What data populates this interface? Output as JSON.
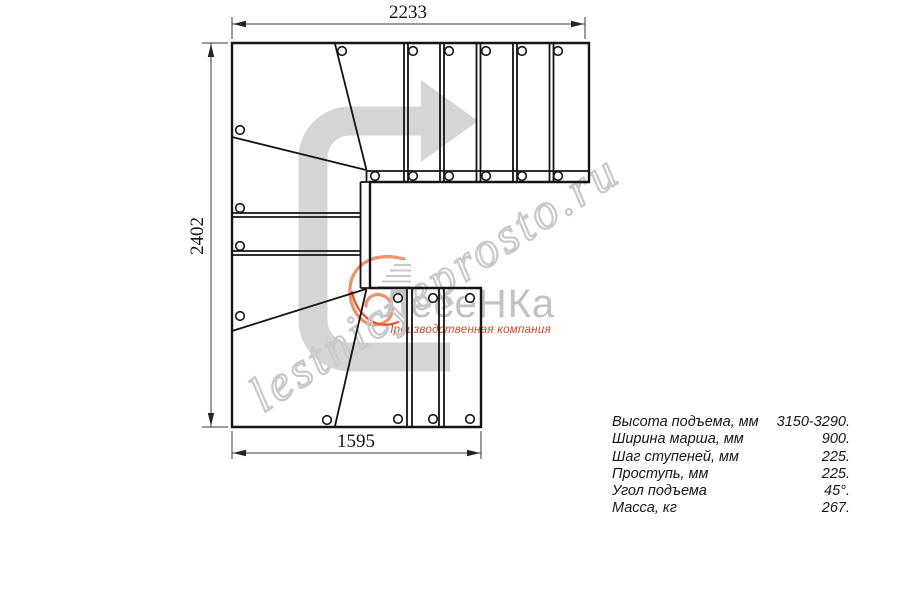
{
  "drawing": {
    "title_hint": "staircase top view plan",
    "dimensions": {
      "top_mm": "2233",
      "left_mm": "2402",
      "bottom_mm": "1595"
    }
  },
  "watermark": {
    "text": "lestnicyeprosto.ru"
  },
  "logo": {
    "brand": "ЛесеНКа",
    "tagline": "Производственная компания"
  },
  "specs": {
    "rows": [
      {
        "label": "Высота подъема, мм",
        "value": "3150-3290."
      },
      {
        "label": "Ширина марша, мм",
        "value": "900."
      },
      {
        "label": "Шаг ступеней, мм",
        "value": "225."
      },
      {
        "label": "Проступь, мм",
        "value": "225."
      },
      {
        "label": "Угол подъема",
        "value": "45°."
      },
      {
        "label": "Масса, кг",
        "value": "267."
      }
    ]
  },
  "colors": {
    "line": "#141414",
    "arrow_gray": "#d5d5d5",
    "watermark_gray": "#c7cacc",
    "logo_orange": "#f0906c",
    "logo_red": "#e0462c",
    "brand_gray": "#bfc3c6"
  }
}
